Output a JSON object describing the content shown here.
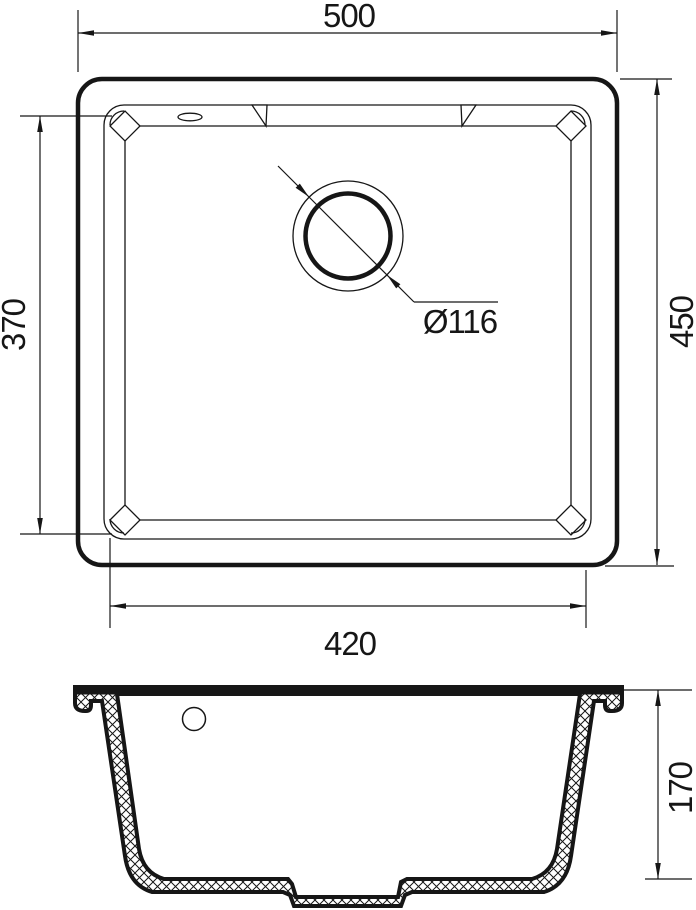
{
  "drawing": {
    "paper_color": "#ffffff",
    "ink_color": "#161616",
    "plan_view": {
      "dim_outer_width": "500",
      "dim_outer_depth": "450",
      "dim_bowl_width": "420",
      "dim_bowl_depth": "370",
      "dim_drain_diameter": "Ø116"
    },
    "section_view": {
      "dim_height": "170"
    }
  }
}
